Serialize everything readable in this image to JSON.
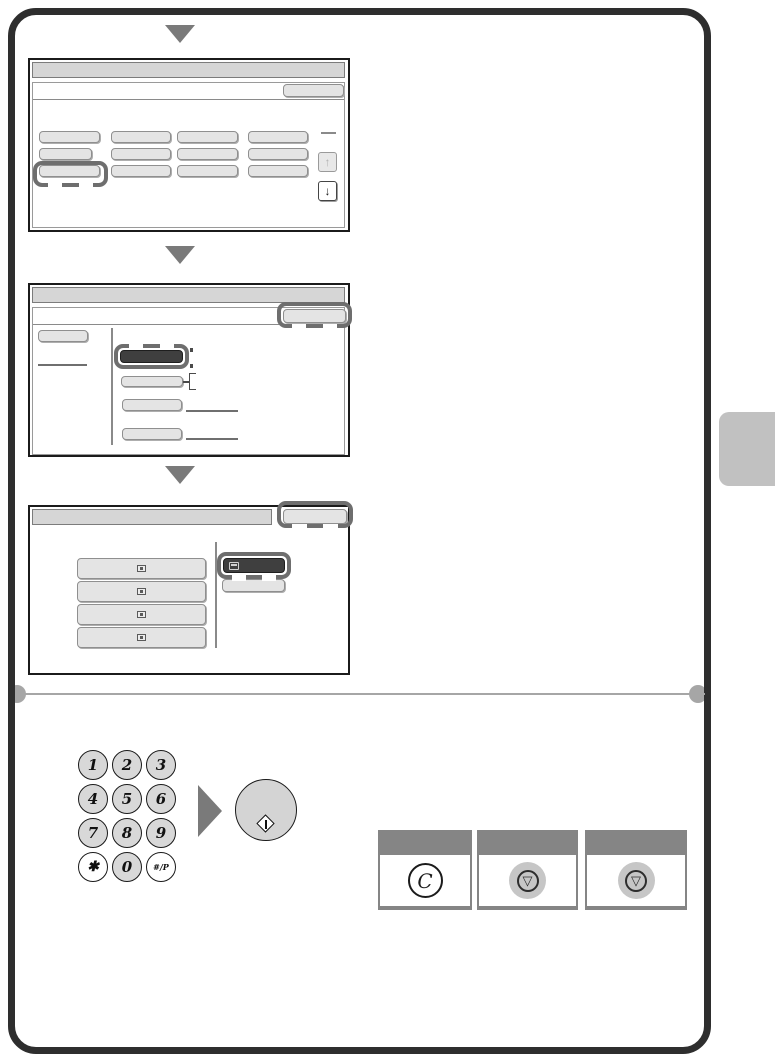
{
  "page": {
    "type": "operation-manual-page",
    "colors": {
      "page_border": "#2e2e2e",
      "screen_border": "#1b1b1b",
      "screen_header": "#d6d6d6",
      "button_fill": "#e4e4e4",
      "button_border": "#8f8f8f",
      "selected_button_fill": "#3f3f3f",
      "highlight_outline": "#6e6e6e",
      "flow_arrow": "#7a7a7a",
      "divider": "#a6a6a6",
      "side_tab": "#c1c1c1",
      "panel_frame": "#858585",
      "keypad_key_fill": "#d8d8d8"
    }
  },
  "flow": {
    "step_screens": 3
  },
  "screen1": {
    "grid_button_count": 12,
    "highlighted_button": "row-3-col-1",
    "scroll_up_glyph": "↑",
    "scroll_down_glyph": "↓"
  },
  "screen2": {
    "left_button_count": 1,
    "list_button_count": 4,
    "selected_button": "row-1-dark",
    "highlighted_button": "ok-top-right"
  },
  "screen3": {
    "list_button_count": 4,
    "selected_button": "dark-with-printer-icon",
    "highlighted_button": "ok-top-right"
  },
  "keypad": {
    "keys": [
      {
        "label": "1"
      },
      {
        "label": "2"
      },
      {
        "label": "3"
      },
      {
        "label": "4"
      },
      {
        "label": "5"
      },
      {
        "label": "6"
      },
      {
        "label": "7"
      },
      {
        "label": "8"
      },
      {
        "label": "9"
      },
      {
        "label": "✱"
      },
      {
        "label": "0"
      },
      {
        "label": "#/P"
      }
    ]
  },
  "start_key": {
    "icon": "start-diamond-icon"
  },
  "panels": [
    {
      "key": "clear-key",
      "glyph": "C"
    },
    {
      "key": "stop-key",
      "glyph": "▽"
    },
    {
      "key": "stop-key",
      "glyph": "▽"
    }
  ]
}
